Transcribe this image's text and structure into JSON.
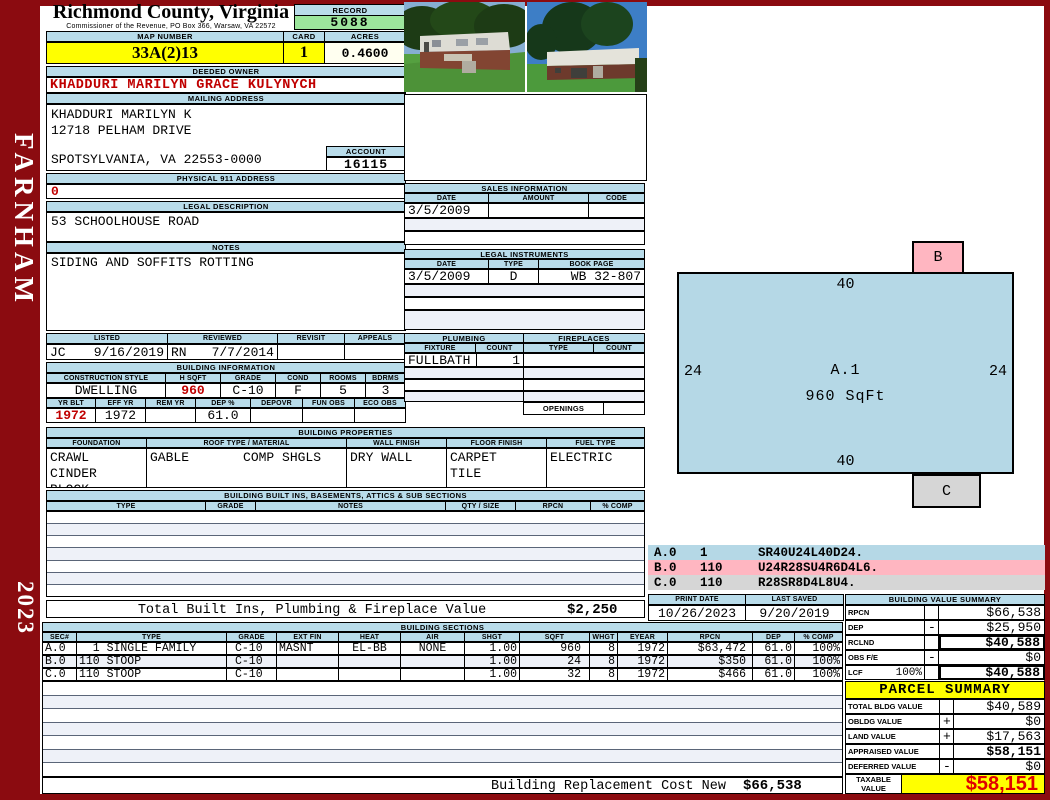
{
  "page": {
    "district": "FARNHAM",
    "year": "2023",
    "county_title": "Richmond County, Virginia",
    "commissioner_line": "Commissioner of the Revenue, PO Box 366, Warsaw, VA 22572"
  },
  "header": {
    "record_label": "RECORD",
    "record_value": "5088",
    "map_number_label": "MAP NUMBER",
    "map_number_value": "33A(2)13",
    "card_label": "CARD",
    "card_value": "1",
    "acres_label": "ACRES",
    "acres_value": "0.4600"
  },
  "owner": {
    "deeded_owner_label": "DEEDED OWNER",
    "deeded_owner_name": "KHADDURI MARILYN GRACE KULYNYCH",
    "mailing_address_label": "MAILING ADDRESS",
    "mailing_line1": "KHADDURI MARILYN K",
    "mailing_line2": "12718 PELHAM DRIVE",
    "mailing_line3": "SPOTSYLVANIA, VA 22553-0000",
    "account_label": "ACCOUNT",
    "account_value": "16115",
    "physical_address_label": "PHYSICAL 911 ADDRESS",
    "physical_address_value": "0",
    "legal_description_label": "LEGAL DESCRIPTION",
    "legal_description_value": "53 SCHOOLHOUSE ROAD",
    "notes_label": "NOTES",
    "notes_value": "SIDING AND SOFFITS ROTTING"
  },
  "visits": {
    "headers": [
      "LISTED",
      "REVIEWED",
      "REVISIT",
      "APPEALS"
    ],
    "listed_by": "JC",
    "listed_date": "9/16/2019",
    "reviewed_by": "RN",
    "reviewed_date": "7/7/2014",
    "revisit": "",
    "appeals": ""
  },
  "building_information": {
    "title": "BUILDING INFORMATION",
    "headers1": [
      "CONSTRUCTION STYLE",
      "H SQFT",
      "GRADE",
      "COND",
      "ROOMS",
      "BDRMS"
    ],
    "values1": [
      "DWELLING",
      "960",
      "C-10",
      "F",
      "5",
      "3"
    ],
    "headers2": [
      "YR BLT",
      "EFF YR",
      "REM YR",
      "DEP %",
      "DEPOVR",
      "FUN OBS",
      "ECO OBS"
    ],
    "values2": [
      "1972",
      "1972",
      "",
      "61.0",
      "",
      "",
      ""
    ]
  },
  "building_properties": {
    "title": "BUILDING PROPERTIES",
    "headers": [
      "FOUNDATION",
      "ROOF TYPE / MATERIAL",
      "WALL FINISH",
      "FLOOR FINISH",
      "FUEL TYPE"
    ],
    "foundation_line1": "CRAWL",
    "foundation_line2": "CINDER BLOCK",
    "roof_type": "GABLE",
    "roof_material": "COMP SHGLS",
    "wall_finish": "DRY WALL",
    "floor_line1": "CARPET",
    "floor_line2": "TILE",
    "fuel_type": "ELECTRIC"
  },
  "built_ins": {
    "title": "BUILDING BUILT INS, BASEMENTS, ATTICS & SUB SECTIONS",
    "headers": [
      "TYPE",
      "GRADE",
      "NOTES",
      "QTY / SIZE",
      "RPCN",
      "% COMP"
    ],
    "total_label": "Total Built Ins, Plumbing & Fireplace Value",
    "total_value": "$2,250"
  },
  "sales": {
    "title": "SALES INFORMATION",
    "headers": [
      "DATE",
      "AMOUNT",
      "CODE"
    ],
    "row1": [
      "3/5/2009",
      "",
      ""
    ]
  },
  "legal_instruments": {
    "title": "LEGAL INSTRUMENTS",
    "headers": [
      "DATE",
      "TYPE",
      "BOOK PAGE"
    ],
    "row1": [
      "3/5/2009",
      "D",
      "WB 32-807"
    ]
  },
  "plumbing": {
    "title": "PLUMBING",
    "headers": [
      "FIXTURE",
      "COUNT"
    ],
    "row1": [
      "FULLBATH",
      "1"
    ]
  },
  "fireplaces": {
    "title": "FIREPLACES",
    "headers": [
      "TYPE",
      "COUNT"
    ],
    "openings_label": "OPENINGS"
  },
  "sketch": {
    "section_label": "A.1",
    "section_sqft": "960 SqFt",
    "dim_top": "40",
    "dim_bottom": "40",
    "dim_left": "24",
    "dim_right": "24",
    "b_label": "B",
    "c_label": "C",
    "legend": [
      {
        "code": "A.0",
        "mult": "1",
        "trace": "SR40U24L40D24."
      },
      {
        "code": "B.0",
        "mult": "110",
        "trace": "U24R28SU4R6D4L6."
      },
      {
        "code": "C.0",
        "mult": "110",
        "trace": "R28SR8D4L8U4."
      }
    ]
  },
  "print_info": {
    "print_date_label": "PRINT DATE",
    "print_date": "10/26/2023",
    "last_saved_label": "LAST SAVED",
    "last_saved": "9/20/2019"
  },
  "building_value_summary": {
    "title": "BUILDING VALUE SUMMARY",
    "rows": [
      {
        "label": "RPCN",
        "pct": "",
        "op": "",
        "value": "$66,538"
      },
      {
        "label": "DEP",
        "pct": "",
        "op": "-",
        "value": "$25,950"
      },
      {
        "label": "RCLND",
        "pct": "",
        "op": "",
        "value": "$40,588"
      },
      {
        "label": "OBS F/E",
        "pct": "",
        "op": "-",
        "value": "$0"
      },
      {
        "label": "LCF",
        "pct": "100%",
        "op": "",
        "value": "$40,588"
      }
    ]
  },
  "building_sections": {
    "title": "BUILDING SECTIONS",
    "headers": [
      "SEC#",
      "TYPE",
      "GRADE",
      "EXT FIN",
      "HEAT",
      "AIR",
      "SHGT",
      "SQFT",
      "WHGT",
      "EYEAR",
      "RPCN",
      "DEP",
      "% COMP"
    ],
    "rows": [
      [
        "A.0",
        "  1 SINGLE FAMILY",
        "C-10",
        "MASNT",
        "EL-BB",
        "NONE",
        "1.00",
        "960",
        "8",
        "1972",
        "$63,472",
        "61.0",
        "100%"
      ],
      [
        "B.0",
        "110 STOOP",
        "C-10",
        "",
        "",
        "",
        "1.00",
        "24",
        "8",
        "1972",
        "$350",
        "61.0",
        "100%"
      ],
      [
        "C.0",
        "110 STOOP",
        "C-10",
        "",
        "",
        "",
        "1.00",
        "32",
        "8",
        "1972",
        "$466",
        "61.0",
        "100%"
      ]
    ]
  },
  "footer": {
    "replacement_label": "Building Replacement Cost New",
    "replacement_value": "$66,538"
  },
  "parcel_summary": {
    "title": "PARCEL SUMMARY",
    "rows": [
      {
        "label": "TOTAL BLDG VALUE",
        "op": "",
        "value": "$40,589"
      },
      {
        "label": "OBLDG VALUE",
        "op": "+",
        "value": "$0"
      },
      {
        "label": "LAND VALUE",
        "op": "+",
        "value": "$17,563"
      },
      {
        "label": "APPRAISED VALUE",
        "op": "",
        "value": "$58,151"
      },
      {
        "label": "DEFERRED VALUE",
        "op": "-",
        "value": "$0"
      }
    ],
    "taxable_label": "TAXABLE VALUE",
    "taxable_value": "$58,151"
  },
  "colors": {
    "frame_red": "#8b0b10",
    "header_blue": "#b9dcea",
    "highlight_yellow": "#ffff00",
    "record_green": "#9ce69c",
    "acres_cream": "#fffff0",
    "data_red": "#c00000",
    "sketch_blue": "#b5d8e6",
    "sketch_pink": "#ffb6c1",
    "sketch_gray": "#d6d6d6"
  }
}
